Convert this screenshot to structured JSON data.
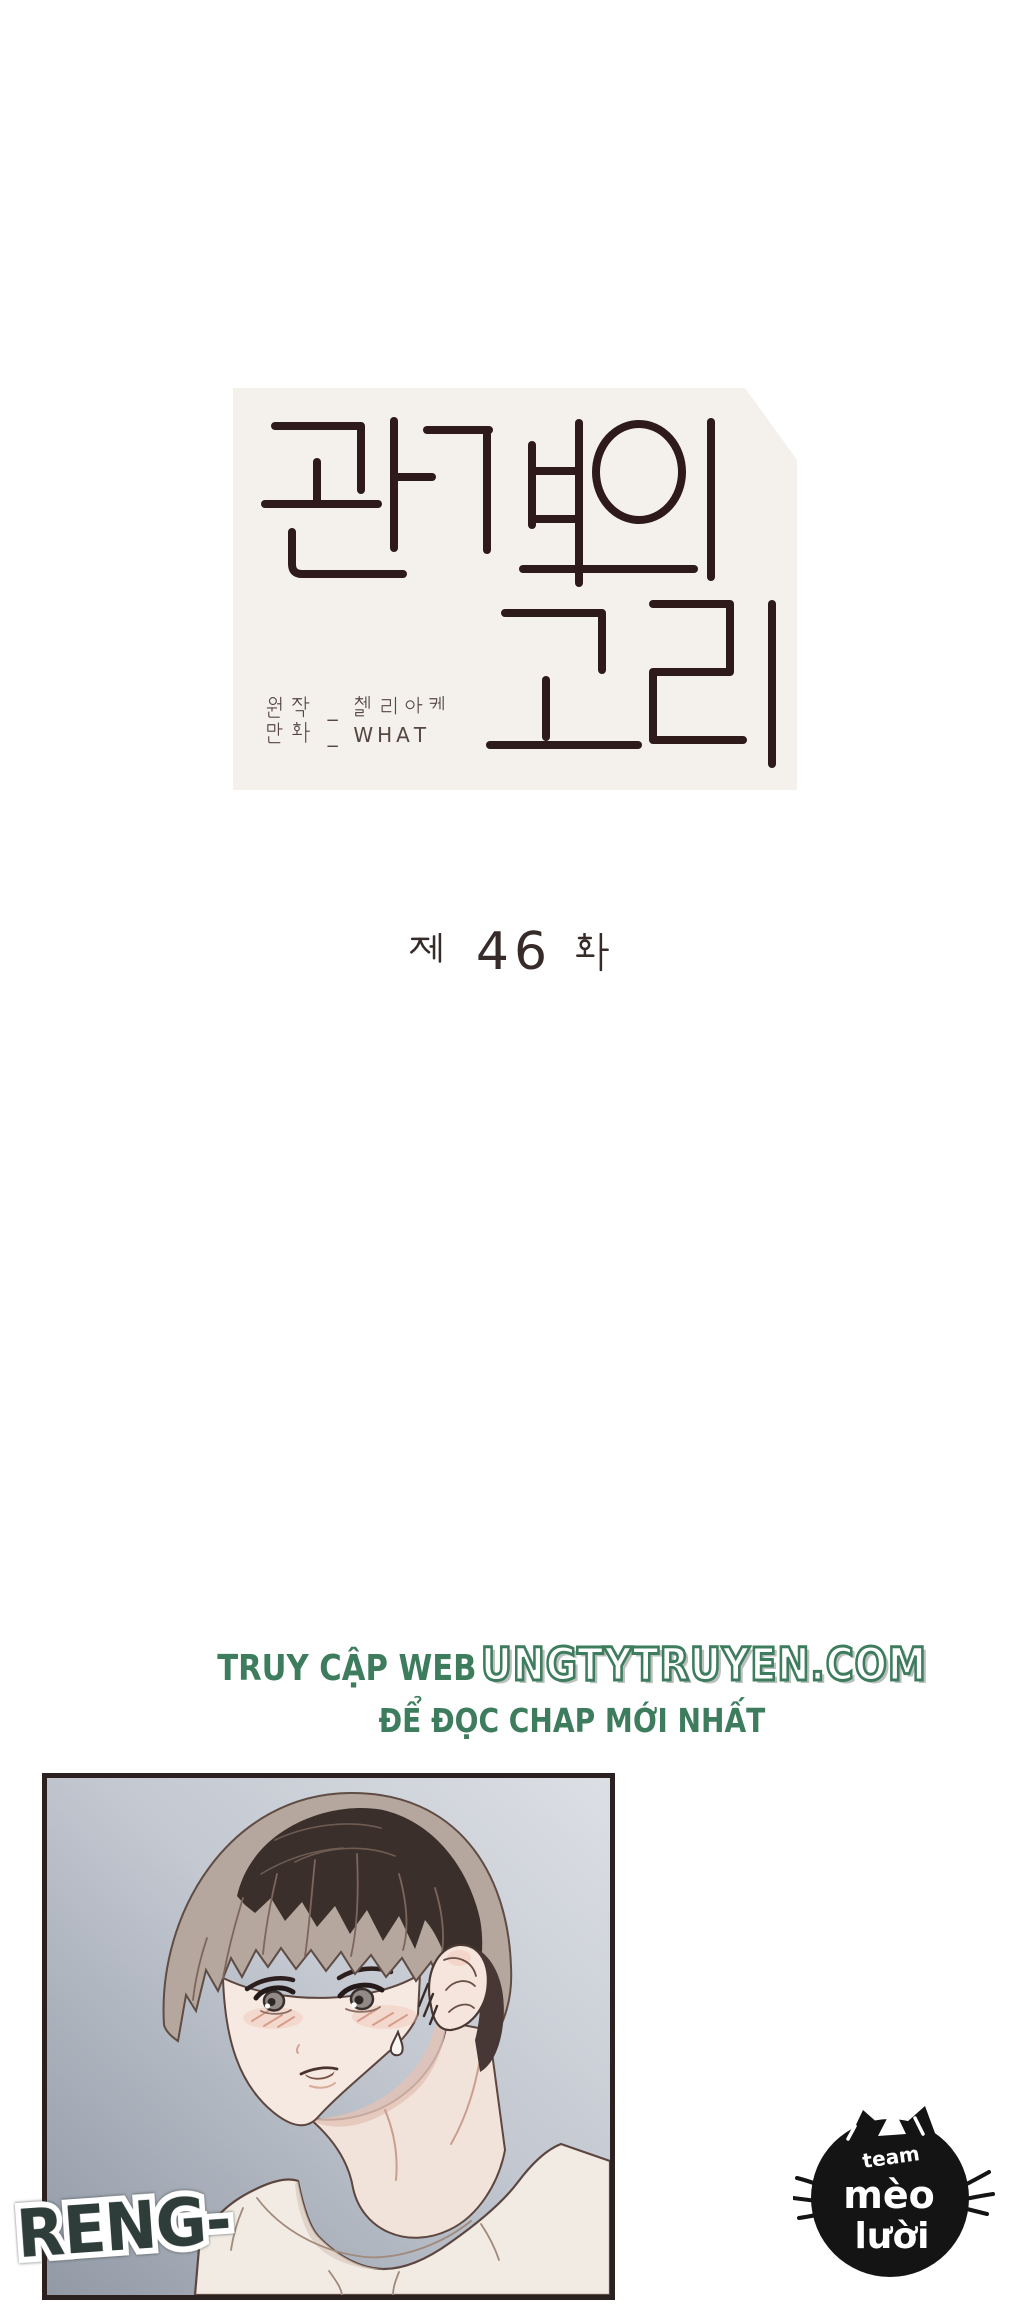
{
  "page": {
    "background": "#ffffff",
    "width": 1024,
    "height": 2300
  },
  "title_card": {
    "bg_color": "#f4f1ec",
    "title_text": "관계의 고리",
    "title_color": "#2e1a18",
    "credits_lines": [
      "원작 _ 첼리아케",
      "만화 _ WHAT"
    ],
    "credits_color": "#55463f"
  },
  "chapter": {
    "text": "제 46 화",
    "number": "46",
    "color": "#362b29"
  },
  "promo": {
    "line1_plain": "TRUY CẬP WEB",
    "line1_site": "UNGTYTRUYEN.COM",
    "line2": "ĐỂ ĐỌC CHAP MỚI NHẤT",
    "color": "#3e7c5e"
  },
  "panel": {
    "border_color": "#2b2121",
    "background_gradient": [
      "#dcdfe4",
      "#c3c8d1",
      "#929aa6"
    ],
    "sfx_text": "RENG-",
    "sfx_color": "#2e3d39",
    "scene": "worried young man with brown bowl-cut hair, blush and sweat drop, white t-shirt"
  },
  "team_logo": {
    "line1": "team",
    "line2": "mèo",
    "line3": "lười",
    "full": "team mèo lười",
    "color": "#141414",
    "text_color": "#ffffff"
  }
}
